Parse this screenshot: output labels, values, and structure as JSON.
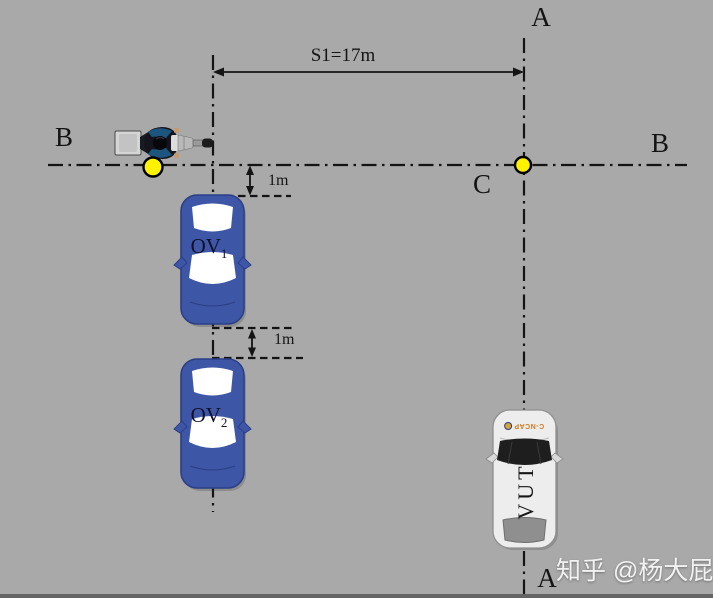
{
  "diagram": {
    "line_labels": {
      "a_top": "A",
      "a_bottom": "A",
      "b_left": "B",
      "b_right": "B",
      "c": "C"
    },
    "dimensions": {
      "s1": "S1=17m",
      "gap_front": "1m",
      "gap_between": "1m"
    },
    "vehicles": {
      "ov1": {
        "name": "OV",
        "sub": "1"
      },
      "ov2": {
        "name": "OV",
        "sub": "2"
      },
      "vut": {
        "label": "VUT",
        "hood_logo": "C-NCAP"
      }
    },
    "colors": {
      "background": "#A9A9A9",
      "line": "#141414",
      "car_blue": "#3E56A6",
      "car_blue_outline": "#2B3F87",
      "vut_body": "#EDEDED",
      "marker_yellow": "#FFF200",
      "watermark_text": "#F2F2F2"
    },
    "watermark": "知乎 @杨大屁"
  }
}
